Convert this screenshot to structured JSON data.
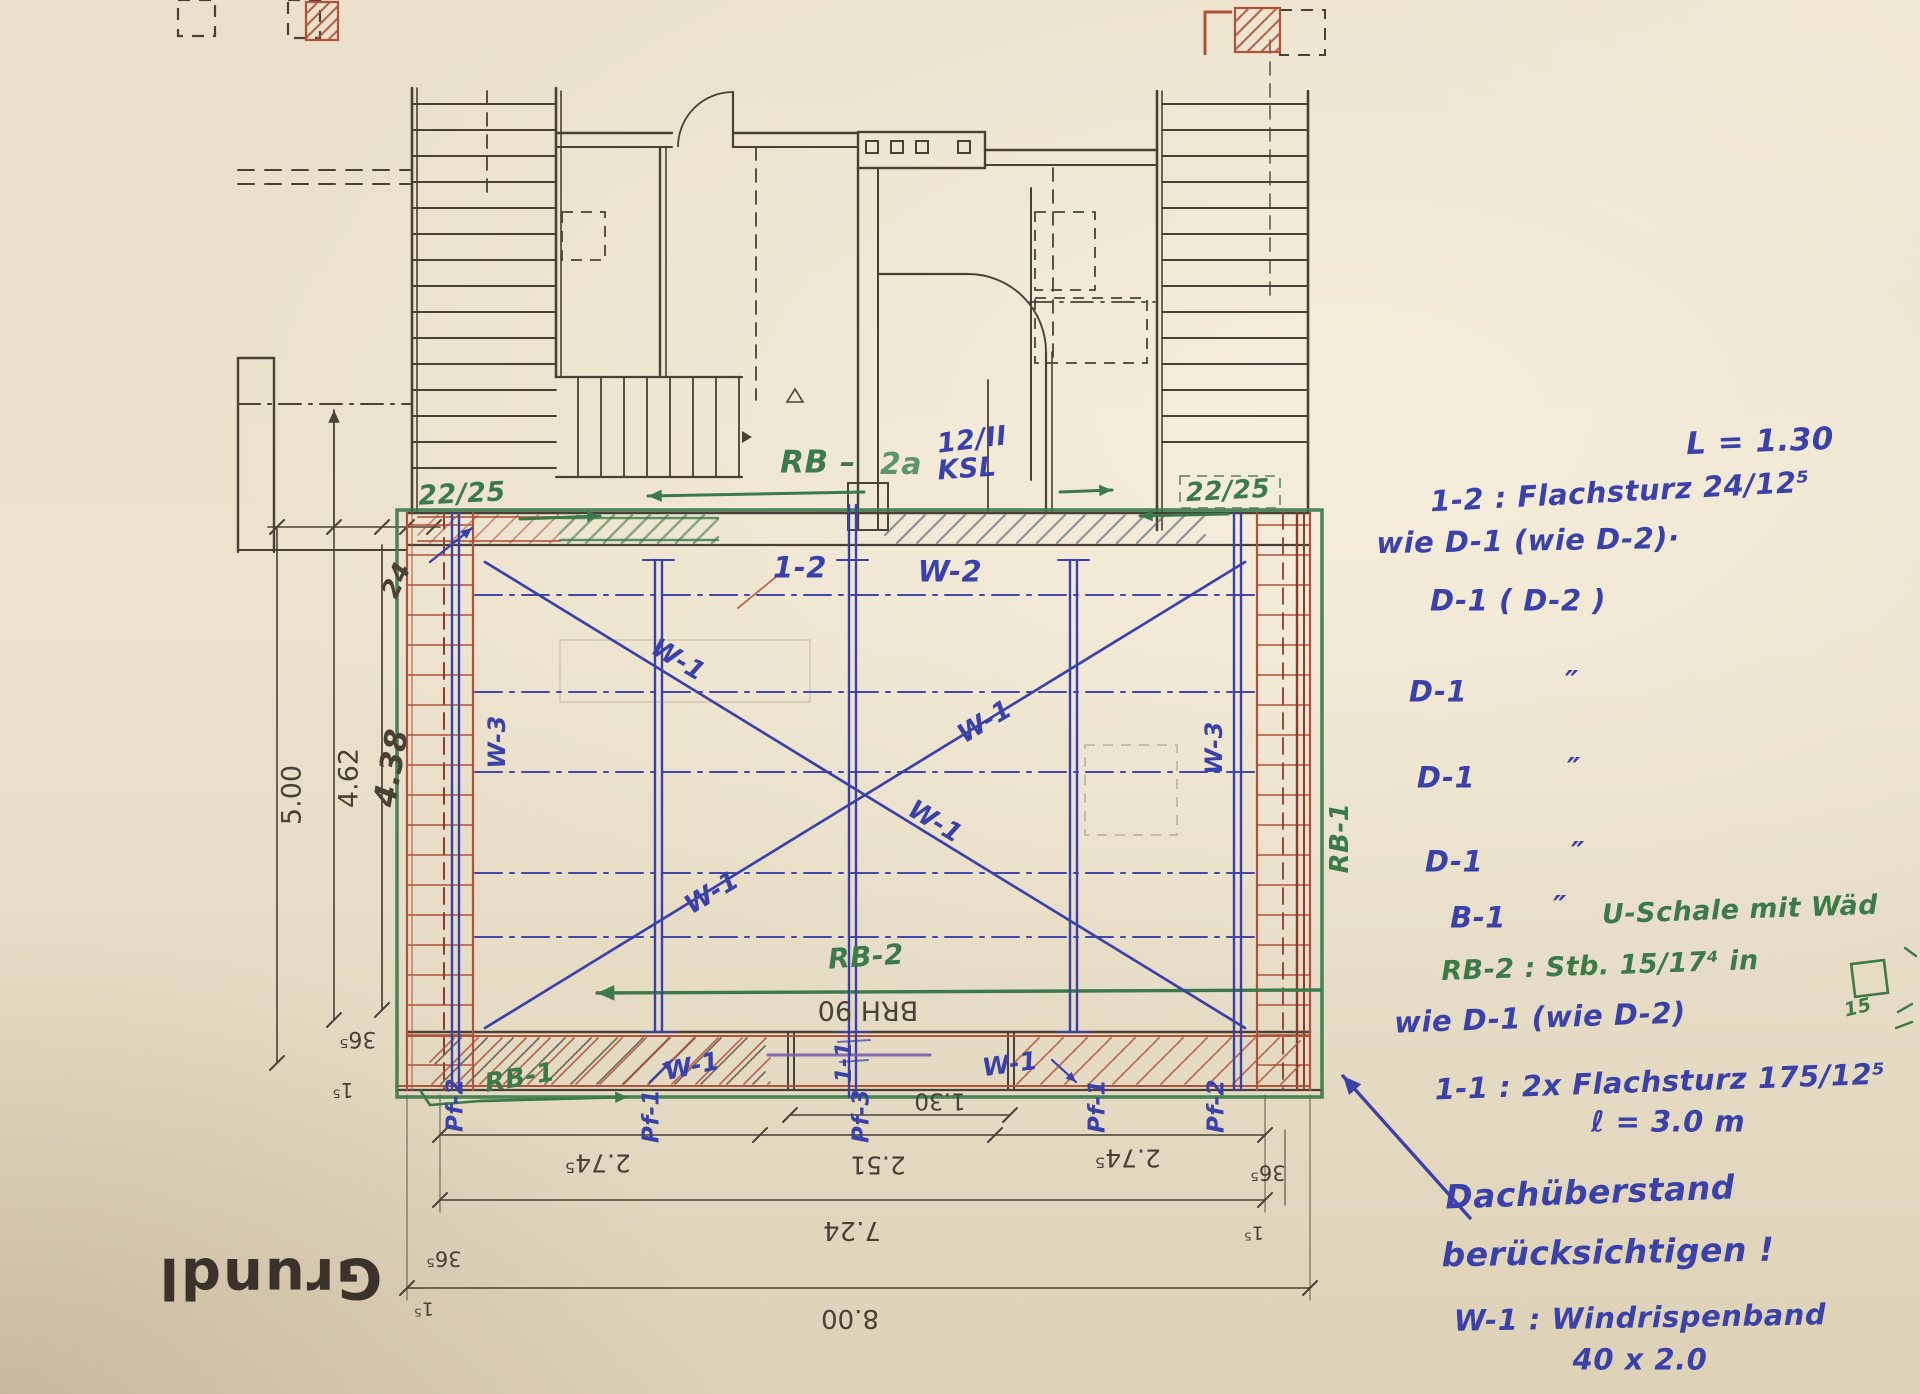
{
  "title_block": {
    "sheet_title": "Grundl"
  },
  "dimensions": {
    "left": {
      "outer": "5.00",
      "inner": "4.62",
      "hand": "4.38",
      "wall": "24",
      "tick_a": "36⁵",
      "tick_b": "1⁵"
    },
    "bottom": {
      "seg_left": "2.74⁵",
      "seg_mid": "2.51",
      "seg_right": "2.74⁵",
      "opening": "1.30",
      "inner_total": "7.24",
      "outer_total": "8.00",
      "tick_left": "36⁵",
      "tick_left2": "1⁵",
      "tick_right": "36⁵",
      "tick_right2": "1⁵"
    },
    "parapet": "BRH 90"
  },
  "plan_marks": {
    "lintel_left": "22/25",
    "lintel_right": "22/25",
    "ring_beam_top": "RB –",
    "ring_beam_top_pos": "2a",
    "masonry_line1": "12/II",
    "masonry_line2": "KSL",
    "pos_12": "1-2",
    "wall_w2": "W-2",
    "wind_brace_w1": "W-1",
    "wall_w3": "W-3",
    "rb2": "RB-2",
    "rb1": "RB-1",
    "pf1": "Pf-1",
    "pf2": "Pf-2",
    "pf3": "Pf-3",
    "pos_11": "1-1"
  },
  "notes": {
    "length": "L = 1.30",
    "pos12_spec": "1-2  :  Flachsturz 24/12⁵",
    "wie_d1_a": "wie D-1   (wie D-2)·",
    "d1_row1": "D-1      ( D-2 )",
    "d1": "D-1",
    "ditto": "″",
    "b1": "B-1",
    "u_schale": "U-Schale mit Wäd",
    "rb2_spec": "RB-2 : Stb. 15/17⁴ in",
    "fifteen": "15",
    "wie_d1_b": "wie D-1  (wie D-2)",
    "pos11_spec": "1-1 :  2x Flachsturz 175/12⁵",
    "len3": "ℓ = 3.0 m",
    "roof1": "Dachüberstand",
    "roof2": "berücksichtigen !",
    "w1_spec": "W-1 :  Windrispenband",
    "w1_spec2": "40 x 2.0"
  }
}
